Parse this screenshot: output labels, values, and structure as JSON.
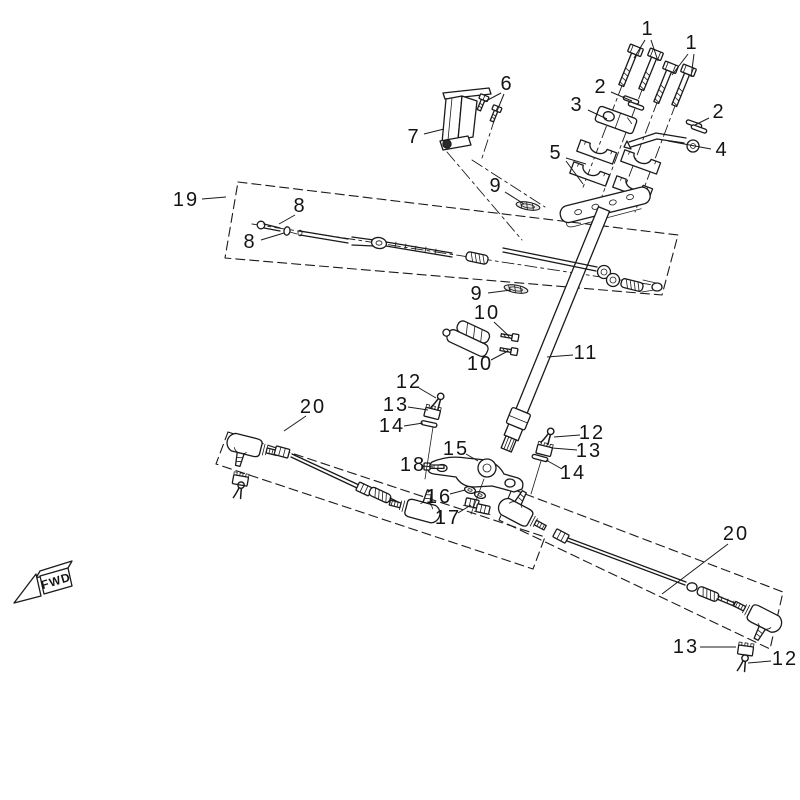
{
  "figure": {
    "fwd_label": "FWD",
    "background": "#ffffff",
    "line_color": "#1a1a1a"
  },
  "callouts": [
    {
      "label": "1",
      "x": 648,
      "y": 29,
      "leaders": [
        [
          [
            645,
            40
          ],
          [
            634,
            58
          ]
        ],
        [
          [
            651,
            40
          ],
          [
            658,
            61
          ]
        ]
      ]
    },
    {
      "label": "1",
      "x": 692,
      "y": 43,
      "leaders": [
        [
          [
            688,
            54
          ],
          [
            672,
            75
          ]
        ],
        [
          [
            694,
            54
          ],
          [
            691,
            77
          ]
        ]
      ]
    },
    {
      "label": "2",
      "x": 601,
      "y": 87,
      "leaders": [
        [
          [
            611,
            92
          ],
          [
            632,
            101
          ]
        ]
      ]
    },
    {
      "label": "3",
      "x": 577,
      "y": 105,
      "leaders": [
        [
          [
            588,
            110
          ],
          [
            607,
            119
          ]
        ]
      ]
    },
    {
      "label": "2",
      "x": 719,
      "y": 112,
      "leaders": [
        [
          [
            709,
            118
          ],
          [
            695,
            125
          ]
        ]
      ]
    },
    {
      "label": "4",
      "x": 722,
      "y": 150,
      "leaders": [
        [
          [
            711,
            149
          ],
          [
            668,
            141
          ]
        ]
      ]
    },
    {
      "label": "5",
      "x": 556,
      "y": 153,
      "leaders": [
        [
          [
            566,
            158
          ],
          [
            586,
            164
          ]
        ],
        [
          [
            566,
            161
          ],
          [
            583,
            184
          ]
        ]
      ]
    },
    {
      "label": "6",
      "x": 507,
      "y": 84,
      "leaders": [
        [
          [
            501,
            93
          ],
          [
            484,
            102
          ]
        ],
        [
          [
            504,
            94
          ],
          [
            497,
            111
          ]
        ]
      ]
    },
    {
      "label": "7",
      "x": 414,
      "y": 137,
      "leaders": [
        [
          [
            424,
            134
          ],
          [
            444,
            129
          ]
        ]
      ]
    },
    {
      "label": "19",
      "x": 186,
      "y": 200,
      "leaders": [
        [
          [
            202,
            199
          ],
          [
            226,
            197
          ]
        ]
      ]
    },
    {
      "label": "8",
      "x": 300,
      "y": 206,
      "leaders": [
        [
          [
            295,
            215
          ],
          [
            279,
            224
          ]
        ]
      ]
    },
    {
      "label": "8",
      "x": 250,
      "y": 242,
      "leaders": [
        [
          [
            261,
            240
          ],
          [
            284,
            233
          ]
        ]
      ]
    },
    {
      "label": "9",
      "x": 496,
      "y": 186,
      "leaders": [
        [
          [
            505,
            192
          ],
          [
            524,
            204
          ]
        ]
      ]
    },
    {
      "label": "9",
      "x": 477,
      "y": 294,
      "leaders": [
        [
          [
            488,
            293
          ],
          [
            511,
            290
          ]
        ]
      ]
    },
    {
      "label": "10",
      "x": 487,
      "y": 313,
      "leaders": [
        [
          [
            494,
            322
          ],
          [
            509,
            336
          ]
        ]
      ]
    },
    {
      "label": "10",
      "x": 480,
      "y": 364,
      "leaders": [
        [
          [
            491,
            360
          ],
          [
            508,
            351
          ]
        ]
      ]
    },
    {
      "label": "11",
      "x": 586,
      "y": 353,
      "leaders": [
        [
          [
            573,
            355
          ],
          [
            547,
            357
          ]
        ]
      ]
    },
    {
      "label": "12",
      "x": 409,
      "y": 382,
      "leaders": [
        [
          [
            419,
            388
          ],
          [
            436,
            398
          ]
        ]
      ]
    },
    {
      "label": "13",
      "x": 396,
      "y": 405,
      "leaders": [
        [
          [
            408,
            407
          ],
          [
            428,
            410
          ]
        ]
      ]
    },
    {
      "label": "14",
      "x": 392,
      "y": 426,
      "leaders": [
        [
          [
            404,
            426
          ],
          [
            423,
            423
          ]
        ]
      ]
    },
    {
      "label": "20",
      "x": 313,
      "y": 407,
      "leaders": [
        [
          [
            306,
            416
          ],
          [
            284,
            431
          ]
        ]
      ]
    },
    {
      "label": "12",
      "x": 592,
      "y": 433,
      "leaders": [
        [
          [
            580,
            435
          ],
          [
            554,
            437
          ]
        ]
      ]
    },
    {
      "label": "13",
      "x": 589,
      "y": 451,
      "leaders": [
        [
          [
            577,
            450
          ],
          [
            552,
            448
          ]
        ]
      ]
    },
    {
      "label": "14",
      "x": 573,
      "y": 473,
      "leaders": [
        [
          [
            562,
            469
          ],
          [
            546,
            460
          ]
        ]
      ]
    },
    {
      "label": "15",
      "x": 456,
      "y": 449,
      "leaders": [
        [
          [
            466,
            454
          ],
          [
            478,
            461
          ]
        ]
      ]
    },
    {
      "label": "18",
      "x": 413,
      "y": 465,
      "leaders": [
        [
          [
            423,
            466
          ],
          [
            433,
            467
          ]
        ]
      ]
    },
    {
      "label": "16",
      "x": 439,
      "y": 497,
      "leaders": [
        [
          [
            450,
            494
          ],
          [
            465,
            490
          ]
        ]
      ]
    },
    {
      "label": "17",
      "x": 448,
      "y": 518,
      "leaders": [
        [
          [
            458,
            513
          ],
          [
            471,
            505
          ]
        ]
      ]
    },
    {
      "label": "20",
      "x": 736,
      "y": 534,
      "leaders": [
        [
          [
            728,
            544
          ],
          [
            662,
            594
          ]
        ]
      ]
    },
    {
      "label": "13",
      "x": 686,
      "y": 647,
      "leaders": [
        [
          [
            700,
            647
          ],
          [
            736,
            647
          ]
        ]
      ]
    },
    {
      "label": "12",
      "x": 785,
      "y": 659,
      "leaders": [
        [
          [
            771,
            661
          ],
          [
            748,
            663
          ]
        ]
      ]
    }
  ]
}
